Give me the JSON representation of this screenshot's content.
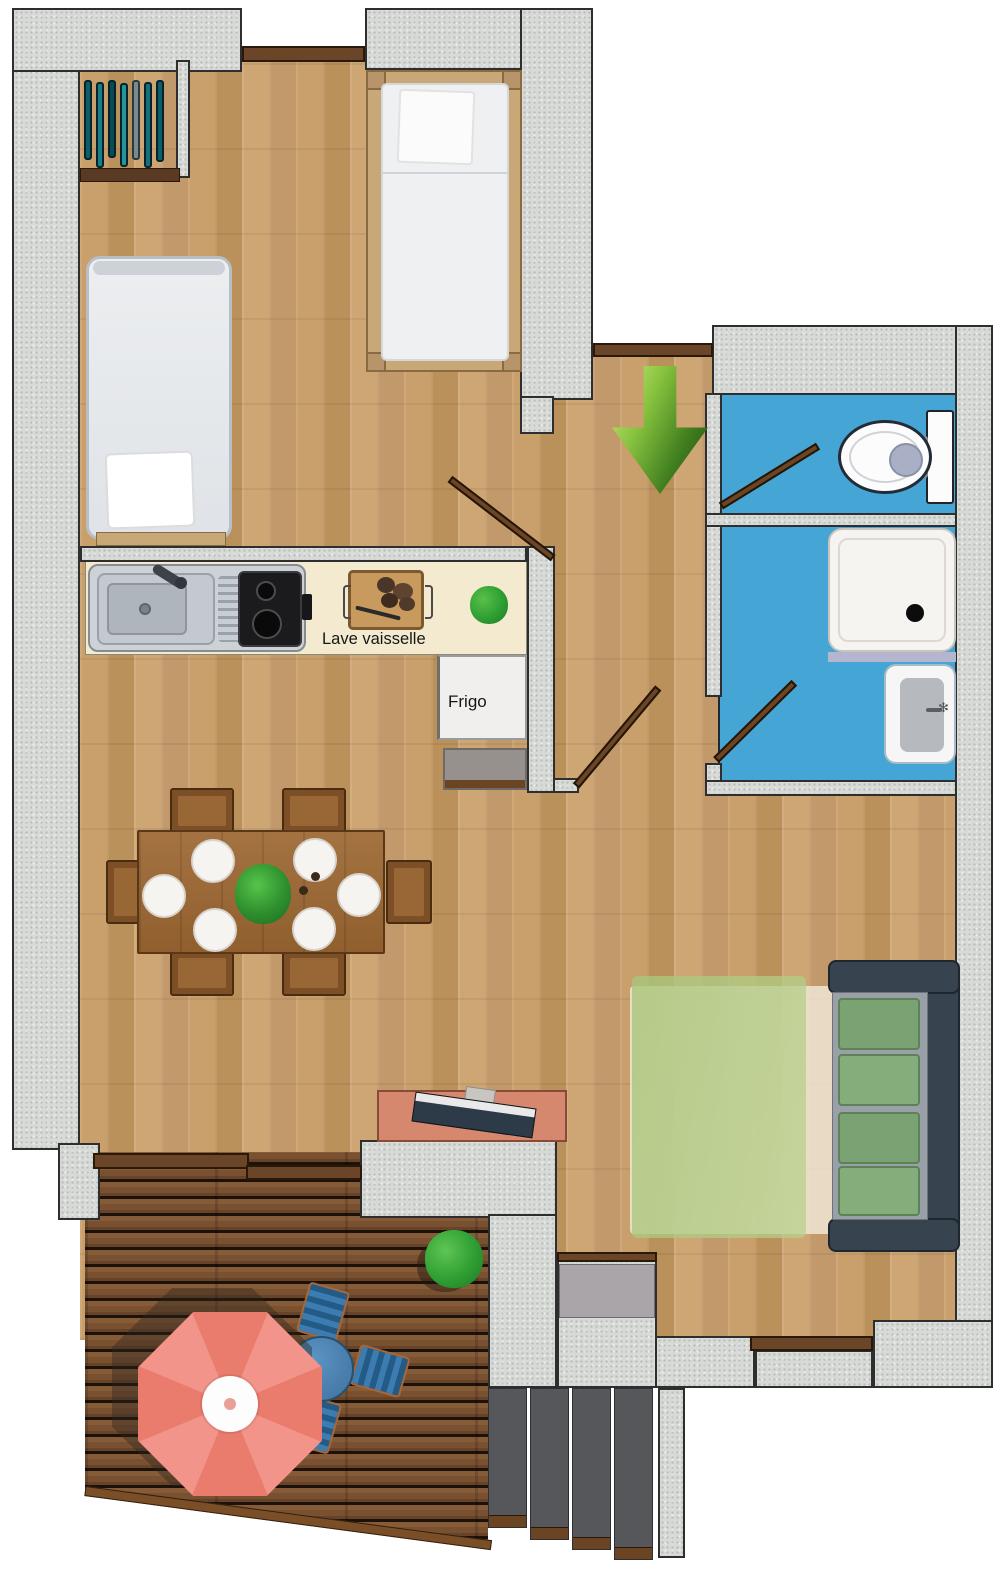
{
  "title": "Apartment floor plan",
  "labels": {
    "dishwasher": "Lave vaisselle",
    "fridge": "Frigo",
    "sink_sparkle": "✻"
  },
  "colors": {
    "wall": "#d7dad6",
    "wall_outline": "#2e2e2e",
    "floor_wood": "#c49b67",
    "terrace_deck": "#7a5130",
    "bathroom_floor": "#45a6d6",
    "kitchen_counter": "#f3ead0",
    "entrance_arrow_green": "#5a9e2f",
    "umbrella_coral": "#ee887a",
    "terrace_table_blue": "#4a84b4",
    "sofa_navy": "#37434f",
    "sofa_cushion_green": "#7ba273",
    "rug_green": "#b3cc8a",
    "door_brown": "#6b4527",
    "wardrobe_teal": "#15707b",
    "desk_salmon": "#d5886e"
  }
}
